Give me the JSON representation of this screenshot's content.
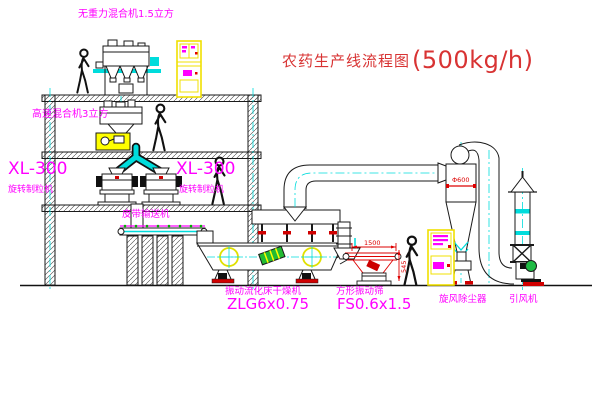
{
  "title": {
    "name": "农药生产线流程图",
    "capacity": "(500kg/h)"
  },
  "equipment_labels": {
    "gravity_free_mixer": "无重力混合机1.5立方",
    "high_speed_mixer": "高速混合机3立方",
    "granulator_left": {
      "model": "XL-300",
      "name": "旋转制粒机"
    },
    "granulator_right": {
      "model": "XL-300",
      "name": "旋转制粒机"
    },
    "belt_conveyor": "皮带输送机",
    "fluid_bed_dryer": {
      "name": "振动流化床干燥机",
      "model": "ZLG6x0.75"
    },
    "square_vibrating_screen": {
      "name": "方形振动筛",
      "model": "FS0.6x1.5"
    },
    "cyclone_dust_collector": "旋风除尘器",
    "induced_draft_fan": "引风机"
  },
  "dimensions": {
    "cyclone_diameter": "Φ600",
    "screen_length": "1500",
    "screen_height": "545"
  },
  "colors": {
    "label_magenta": "#ff00ff",
    "title_red": "#d83333",
    "dimension_red": "#dd0000",
    "line_black": "#1a1a1a",
    "centerline_cyan": "#00dcdc",
    "cabinet_yellow": "#f0e000",
    "machine_yellow": "#ffff00",
    "motor_green": "#22bb33",
    "foot_red": "#d00000"
  }
}
